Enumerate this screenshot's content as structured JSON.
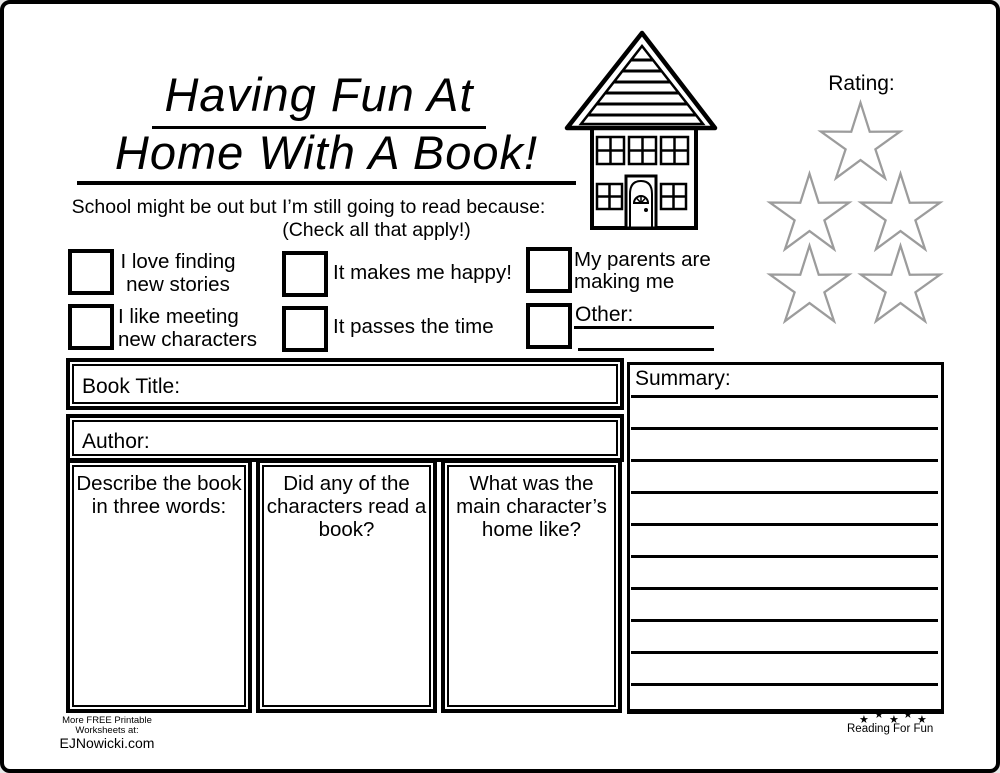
{
  "header": {
    "title_line1": "Having Fun At",
    "title_line2": "Home With A Book!",
    "subtitle": "School might be out but I’m still going to read because:",
    "subtitle_note": "(Check all that apply!)"
  },
  "rating": {
    "label": "Rating:",
    "star_count": 5,
    "star_outline_color": "#9c9c9c"
  },
  "reasons": [
    {
      "lines": [
        "I love finding",
        "new stories"
      ]
    },
    {
      "lines": [
        "It makes me happy!"
      ]
    },
    {
      "lines": [
        "My parents are",
        "making me"
      ]
    },
    {
      "lines": [
        "I like meeting",
        "new characters"
      ]
    },
    {
      "lines": [
        "It passes the time"
      ]
    },
    {
      "lines": [
        "Other:"
      ]
    }
  ],
  "form": {
    "book_title_label": "Book Title:",
    "author_label": "Author:",
    "column1": {
      "lines": [
        "Describe the book",
        "in three words:"
      ]
    },
    "column2": {
      "lines": [
        "Did any of the",
        "characters read a",
        "book?"
      ]
    },
    "column3": {
      "lines": [
        "What was the",
        "main character’s",
        "home like?"
      ]
    },
    "summary_label": "Summary:"
  },
  "footer": {
    "promo_line1": "More FREE Printable",
    "promo_line2": "Worksheets at:",
    "promo_line3": "EJNowicki.com",
    "brand": "Reading For Fun",
    "star_glyph": "★"
  }
}
